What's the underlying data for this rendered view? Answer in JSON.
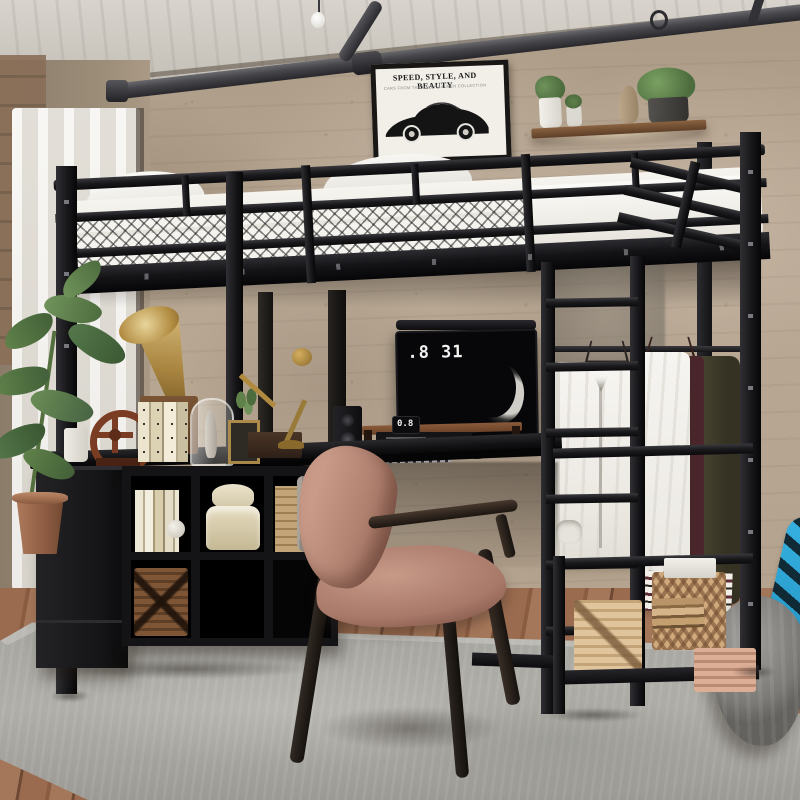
{
  "scene_title": "Black metal loft bed with desk workstation in industrial loft bedroom",
  "poster": {
    "title": "SPEED, STYLE, AND BEAUTY",
    "subtitle": "CARS FROM THE RALPH LAUREN COLLECTION"
  },
  "monitor": {
    "clock_text": ".8 31",
    "wallpaper": "crescent-moon"
  },
  "desk_clock": {
    "time_text": "0.8"
  },
  "objects": [
    "loft-bed-frame",
    "guard-rails",
    "mattress-bedding",
    "pillows",
    "ladder",
    "ceiling-pipe",
    "hanging-bulb",
    "framed-car-poster",
    "wall-shelf",
    "potted-plants",
    "sheer-curtain",
    "l-shaped-desk",
    "monitor",
    "monitor-light-bar",
    "keyboard",
    "mouse",
    "speaker",
    "wooden-monitor-riser",
    "digital-clock",
    "gramophone",
    "brass-desk-lamp",
    "gear-bookend",
    "books",
    "glass-cloche",
    "photo-frame",
    "storage-cabinet",
    "cube-organizer",
    "wicker-baskets",
    "hat-boxes",
    "gray-towel",
    "mauve-armchair",
    "clothes-rod",
    "white-shirt",
    "varsity-jacket",
    "right-storage-shelf",
    "white-box",
    "book-stack",
    "pink-basket",
    "gray-pouf",
    "blue-skateboard",
    "gray-area-rug",
    "wood-floor",
    "floor-plant",
    "terracotta-pot"
  ],
  "palette": {
    "frame_black": "#1b1b1d",
    "wall_plaster_tan": "#b6a793",
    "ceiling_concrete": "#cdc9c2",
    "bedding_white": "#f2efe9",
    "chair_mauve": "#b98a7d",
    "brass": "#b08a3f",
    "wood_brown": "#7a4a30",
    "rug_gray": "#a8a8a4",
    "floor_wood": "#96684c",
    "skateboard_blue": "#2aa3d6",
    "wicker_dark": "#6e4a2e",
    "wicker_light": "#b79a72",
    "maroon_knit": "#5c2f36",
    "olive_knit": "#3f3c2a"
  }
}
